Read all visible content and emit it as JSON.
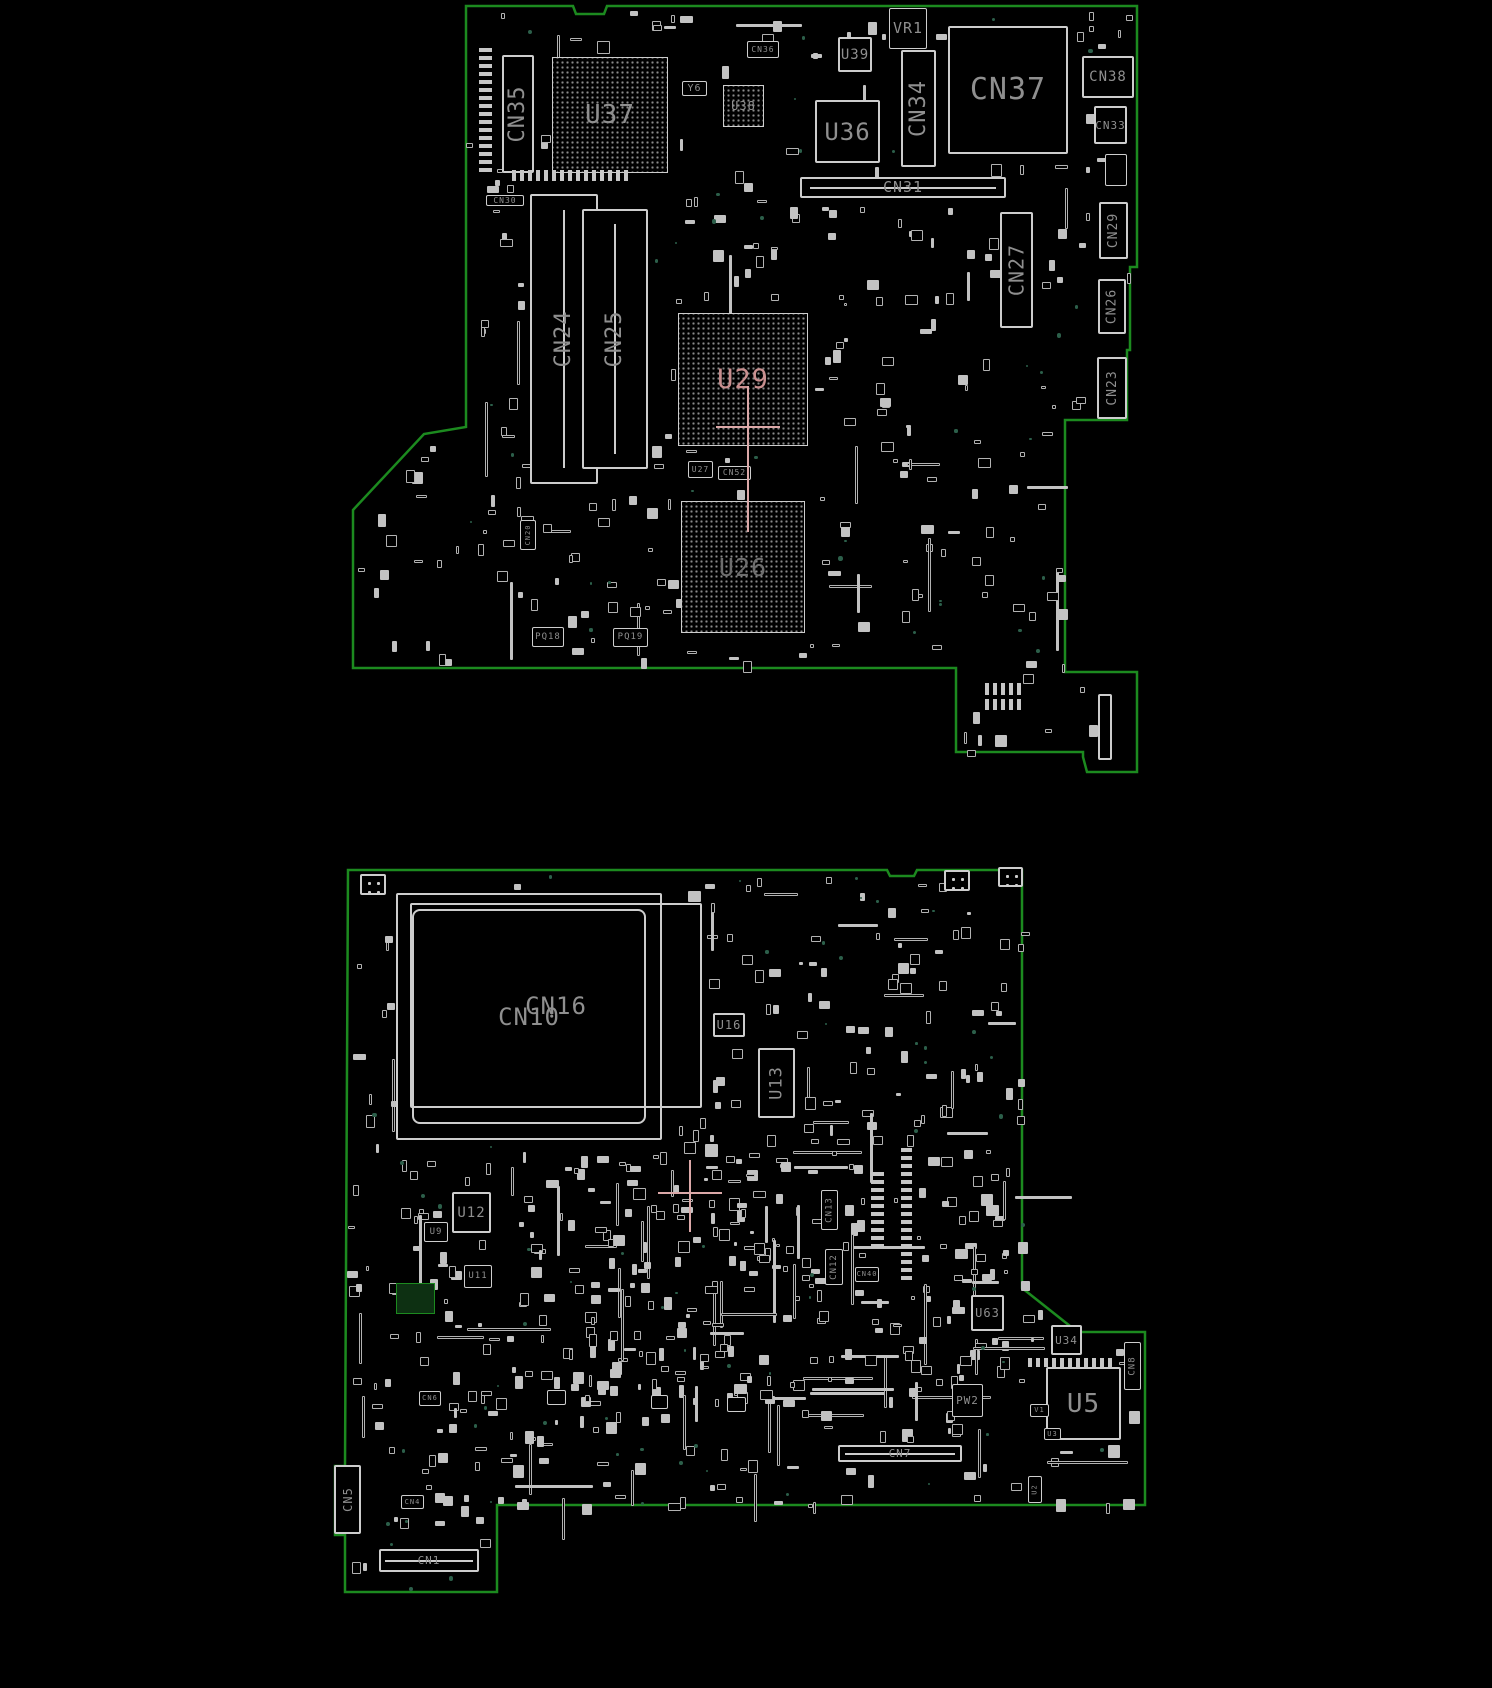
{
  "colors": {
    "board_edge": "#1c8a1f",
    "silkscreen": "#cdcdcd",
    "label": "#8f8f8f",
    "highlight": "#c98f8f",
    "dim": "#6e6e6e",
    "cross": "#dba8a8",
    "teal_testpoint": "#2c5f4a"
  },
  "boards": [
    {
      "name": "top-board",
      "outline": [
        [
          466,
          6
        ],
        [
          573,
          6
        ],
        [
          576,
          14
        ],
        [
          604,
          14
        ],
        [
          607,
          6
        ],
        [
          1137,
          6
        ],
        [
          1137,
          267
        ],
        [
          1130,
          267
        ],
        [
          1130,
          350
        ],
        [
          1127,
          350
        ],
        [
          1127,
          420
        ],
        [
          1065,
          420
        ],
        [
          1065,
          672
        ],
        [
          1137,
          672
        ],
        [
          1137,
          772
        ],
        [
          1087,
          772
        ],
        [
          1083,
          757
        ],
        [
          1083,
          752
        ],
        [
          956,
          752
        ],
        [
          956,
          668
        ],
        [
          353,
          668
        ],
        [
          353,
          510
        ],
        [
          424,
          434
        ],
        [
          466,
          427
        ]
      ],
      "components": [
        {
          "ref": "CN35",
          "x": 502,
          "y": 55,
          "w": 32,
          "h": 118,
          "type": "connector",
          "dir": "v",
          "fs": 22
        },
        {
          "ref": "",
          "x": 479,
          "y": 47,
          "w": 13,
          "h": 125,
          "type": "pinrow-v"
        },
        {
          "ref": "U37",
          "x": 552,
          "y": 57,
          "w": 116,
          "h": 116,
          "type": "bga",
          "fs": 26
        },
        {
          "ref": "",
          "x": 512,
          "y": 170,
          "w": 118,
          "h": 11,
          "type": "pinrow-h"
        },
        {
          "ref": "Y6",
          "x": 682,
          "y": 81,
          "w": 25,
          "h": 15,
          "type": "box",
          "fs": 10
        },
        {
          "ref": "U38",
          "x": 723,
          "y": 85,
          "w": 41,
          "h": 42,
          "type": "bga",
          "fs": 12
        },
        {
          "ref": "CN36",
          "x": 747,
          "y": 41,
          "w": 32,
          "h": 17,
          "type": "box",
          "fs": 8
        },
        {
          "ref": "U39",
          "x": 838,
          "y": 37,
          "w": 34,
          "h": 35,
          "type": "ic",
          "fs": 14
        },
        {
          "ref": "VR1",
          "x": 889,
          "y": 8,
          "w": 38,
          "h": 41,
          "type": "box",
          "fs": 15
        },
        {
          "ref": "U36",
          "x": 815,
          "y": 100,
          "w": 65,
          "h": 63,
          "type": "ic",
          "fs": 24
        },
        {
          "ref": "CN34",
          "x": 901,
          "y": 50,
          "w": 35,
          "h": 117,
          "type": "connector",
          "dir": "v",
          "fs": 22
        },
        {
          "ref": "CN37",
          "x": 948,
          "y": 26,
          "w": 120,
          "h": 128,
          "type": "connector",
          "fs": 30
        },
        {
          "ref": "CN31",
          "x": 800,
          "y": 177,
          "w": 206,
          "h": 21,
          "type": "connector-slot-h",
          "fs": 15
        },
        {
          "ref": "CN30",
          "x": 486,
          "y": 195,
          "w": 38,
          "h": 11,
          "type": "box",
          "fs": 8
        },
        {
          "ref": "CN24",
          "x": 530,
          "y": 194,
          "w": 68,
          "h": 290,
          "type": "dimm",
          "dir": "v",
          "fs": 22
        },
        {
          "ref": "CN25",
          "x": 582,
          "y": 209,
          "w": 66,
          "h": 260,
          "type": "dimm",
          "dir": "v",
          "fs": 22
        },
        {
          "ref": "CN27",
          "x": 1000,
          "y": 212,
          "w": 33,
          "h": 116,
          "type": "connector",
          "dir": "v",
          "fs": 20
        },
        {
          "ref": "CN38",
          "x": 1082,
          "y": 56,
          "w": 52,
          "h": 42,
          "type": "connector",
          "fs": 14
        },
        {
          "ref": "CN33",
          "x": 1094,
          "y": 106,
          "w": 33,
          "h": 38,
          "type": "connector",
          "fs": 11
        },
        {
          "ref": "",
          "x": 1105,
          "y": 154,
          "w": 22,
          "h": 32,
          "type": "box"
        },
        {
          "ref": "CN29",
          "x": 1099,
          "y": 202,
          "w": 29,
          "h": 57,
          "type": "connector",
          "dir": "v",
          "fs": 13
        },
        {
          "ref": "CN26",
          "x": 1098,
          "y": 279,
          "w": 28,
          "h": 55,
          "type": "connector",
          "dir": "v",
          "fs": 13
        },
        {
          "ref": "CN23",
          "x": 1097,
          "y": 357,
          "w": 30,
          "h": 62,
          "type": "connector",
          "dir": "v",
          "fs": 13
        },
        {
          "ref": "CN20",
          "x": 520,
          "y": 520,
          "w": 16,
          "h": 30,
          "type": "box",
          "dir": "v",
          "fs": 7
        },
        {
          "ref": "U29",
          "x": 678,
          "y": 313,
          "w": 130,
          "h": 133,
          "type": "bga",
          "fs": 27,
          "color": "highlight"
        },
        {
          "ref": "U27",
          "x": 688,
          "y": 461,
          "w": 25,
          "h": 17,
          "type": "box",
          "fs": 8
        },
        {
          "ref": "CN52",
          "x": 718,
          "y": 466,
          "w": 33,
          "h": 14,
          "type": "box",
          "fs": 8
        },
        {
          "ref": "U26",
          "x": 681,
          "y": 501,
          "w": 124,
          "h": 132,
          "type": "bga",
          "fs": 25,
          "color": "dim"
        },
        {
          "ref": "PQ18",
          "x": 532,
          "y": 627,
          "w": 32,
          "h": 20,
          "type": "box",
          "fs": 9
        },
        {
          "ref": "PQ19",
          "x": 613,
          "y": 628,
          "w": 35,
          "h": 19,
          "type": "box",
          "fs": 9
        },
        {
          "ref": "",
          "x": 985,
          "y": 683,
          "w": 36,
          "h": 12,
          "type": "pinrow-h"
        },
        {
          "ref": "",
          "x": 985,
          "y": 699,
          "w": 36,
          "h": 11,
          "type": "pinrow-h"
        },
        {
          "ref": "",
          "x": 1098,
          "y": 694,
          "w": 14,
          "h": 66,
          "type": "connector"
        },
        {
          "ref": "",
          "x": 716,
          "y": 426,
          "w": 64,
          "h": 2,
          "type": "hline",
          "color": "cross"
        },
        {
          "ref": "",
          "x": 747,
          "y": 386,
          "w": 2,
          "h": 146,
          "type": "vline",
          "color": "cross"
        }
      ]
    },
    {
      "name": "bottom-board",
      "outline": [
        [
          348,
          870
        ],
        [
          887,
          870
        ],
        [
          890,
          876
        ],
        [
          914,
          876
        ],
        [
          917,
          870
        ],
        [
          1022,
          870
        ],
        [
          1022,
          1288
        ],
        [
          1070,
          1326
        ],
        [
          1070,
          1332
        ],
        [
          1145,
          1332
        ],
        [
          1145,
          1505
        ],
        [
          497,
          1505
        ],
        [
          497,
          1592
        ],
        [
          345,
          1592
        ],
        [
          345,
          1535
        ],
        [
          335,
          1535
        ],
        [
          335,
          1466
        ],
        [
          345,
          1466
        ]
      ],
      "components": [
        {
          "ref": "CN10",
          "x": 396,
          "y": 893,
          "w": 266,
          "h": 247,
          "type": "socket",
          "fs": 24
        },
        {
          "ref": "CN16",
          "x": 410,
          "y": 903,
          "w": 292,
          "h": 205,
          "type": "rect-open",
          "fs": 24
        },
        {
          "ref": "U16",
          "x": 713,
          "y": 1013,
          "w": 32,
          "h": 24,
          "type": "ic",
          "fs": 12
        },
        {
          "ref": "U13",
          "x": 758,
          "y": 1048,
          "w": 37,
          "h": 70,
          "type": "ic",
          "dir": "v",
          "fs": 17
        },
        {
          "ref": "U12",
          "x": 452,
          "y": 1192,
          "w": 39,
          "h": 41,
          "type": "ic",
          "fs": 14
        },
        {
          "ref": "U9",
          "x": 424,
          "y": 1222,
          "w": 24,
          "h": 20,
          "type": "box",
          "fs": 9
        },
        {
          "ref": "U11",
          "x": 464,
          "y": 1265,
          "w": 28,
          "h": 23,
          "type": "box",
          "fs": 9
        },
        {
          "ref": "CN13",
          "x": 821,
          "y": 1190,
          "w": 17,
          "h": 40,
          "type": "box",
          "dir": "v",
          "fs": 9
        },
        {
          "ref": "CN12",
          "x": 825,
          "y": 1249,
          "w": 18,
          "h": 36,
          "type": "box",
          "dir": "v",
          "fs": 9
        },
        {
          "ref": "CN40",
          "x": 855,
          "y": 1267,
          "w": 24,
          "h": 15,
          "type": "box",
          "fs": 7
        },
        {
          "ref": "U63",
          "x": 971,
          "y": 1295,
          "w": 33,
          "h": 36,
          "type": "ic",
          "fs": 12
        },
        {
          "ref": "U34",
          "x": 1051,
          "y": 1325,
          "w": 31,
          "h": 30,
          "type": "ic",
          "fs": 11
        },
        {
          "ref": "PW2",
          "x": 952,
          "y": 1384,
          "w": 31,
          "h": 33,
          "type": "box",
          "fs": 11
        },
        {
          "ref": "U5",
          "x": 1046,
          "y": 1367,
          "w": 75,
          "h": 73,
          "type": "ic",
          "fs": 26
        },
        {
          "ref": "CN7",
          "x": 838,
          "y": 1445,
          "w": 124,
          "h": 17,
          "type": "connector-slot-h",
          "fs": 11
        },
        {
          "ref": "CN8",
          "x": 1124,
          "y": 1342,
          "w": 17,
          "h": 48,
          "type": "box",
          "dir": "v",
          "fs": 9
        },
        {
          "ref": "V1",
          "x": 1030,
          "y": 1404,
          "w": 19,
          "h": 13,
          "type": "box",
          "fs": 7
        },
        {
          "ref": "U3",
          "x": 1044,
          "y": 1428,
          "w": 17,
          "h": 12,
          "type": "box",
          "fs": 7
        },
        {
          "ref": "U2",
          "x": 1028,
          "y": 1476,
          "w": 14,
          "h": 27,
          "type": "box",
          "dir": "v",
          "fs": 7
        },
        {
          "ref": "CN6",
          "x": 419,
          "y": 1391,
          "w": 22,
          "h": 15,
          "type": "box",
          "fs": 7
        },
        {
          "ref": "CN4",
          "x": 401,
          "y": 1495,
          "w": 23,
          "h": 14,
          "type": "box",
          "fs": 7
        },
        {
          "ref": "CN5",
          "x": 334,
          "y": 1465,
          "w": 27,
          "h": 69,
          "type": "connector",
          "dir": "v",
          "fs": 12
        },
        {
          "ref": "CN1",
          "x": 379,
          "y": 1549,
          "w": 100,
          "h": 23,
          "type": "connector-slot-h",
          "fs": 11
        },
        {
          "ref": "",
          "x": 547,
          "y": 1390,
          "w": 19,
          "h": 15,
          "type": "box"
        },
        {
          "ref": "",
          "x": 651,
          "y": 1395,
          "w": 17,
          "h": 14,
          "type": "box"
        },
        {
          "ref": "",
          "x": 727,
          "y": 1397,
          "w": 19,
          "h": 15,
          "type": "box"
        },
        {
          "ref": "",
          "x": 396,
          "y": 1283,
          "w": 39,
          "h": 31,
          "type": "pad-green"
        },
        {
          "ref": "",
          "x": 360,
          "y": 874,
          "w": 26,
          "h": 21,
          "type": "fiducial"
        },
        {
          "ref": "",
          "x": 944,
          "y": 870,
          "w": 26,
          "h": 21,
          "type": "fiducial"
        },
        {
          "ref": "",
          "x": 998,
          "y": 867,
          "w": 25,
          "h": 20,
          "type": "fiducial"
        },
        {
          "ref": "",
          "x": 871,
          "y": 1170,
          "w": 13,
          "h": 78,
          "type": "pinrow-v"
        },
        {
          "ref": "",
          "x": 901,
          "y": 1148,
          "w": 11,
          "h": 132,
          "type": "pinrow-v"
        },
        {
          "ref": "",
          "x": 1028,
          "y": 1358,
          "w": 84,
          "h": 9,
          "type": "pinrow-h"
        },
        {
          "ref": "",
          "x": 658,
          "y": 1192,
          "w": 64,
          "h": 2,
          "type": "hline",
          "color": "cross"
        },
        {
          "ref": "",
          "x": 689,
          "y": 1160,
          "w": 2,
          "h": 72,
          "type": "vline",
          "color": "cross"
        }
      ]
    }
  ]
}
